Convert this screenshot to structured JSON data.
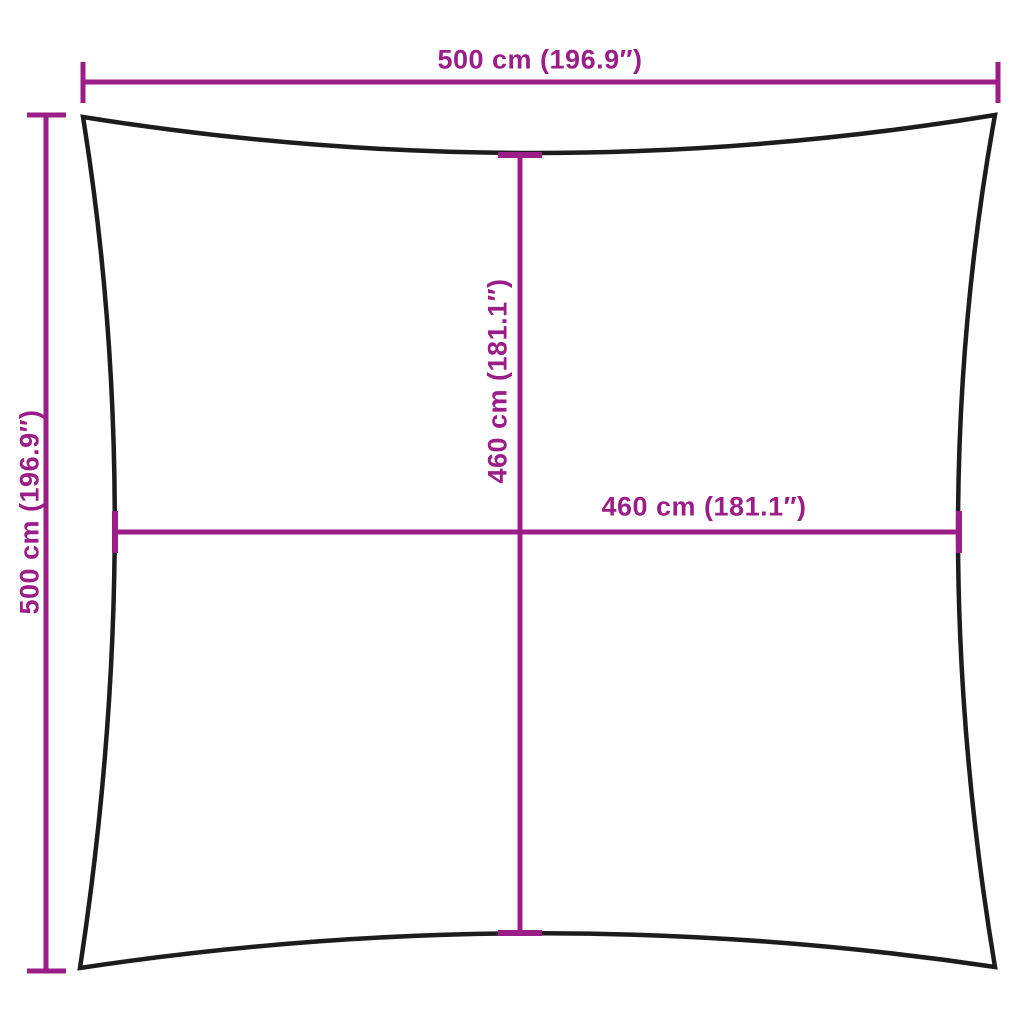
{
  "diagram": {
    "colors": {
      "dimension": "#9B1D87",
      "outline": "#1C1C1C",
      "background": "#FFFFFF"
    },
    "dimensions": {
      "outer_width": "500 cm (196.9″)",
      "outer_height": "500 cm (196.9″)",
      "inner_height": "460 cm (181.1″)",
      "inner_width": "460 cm (181.1″)"
    }
  }
}
